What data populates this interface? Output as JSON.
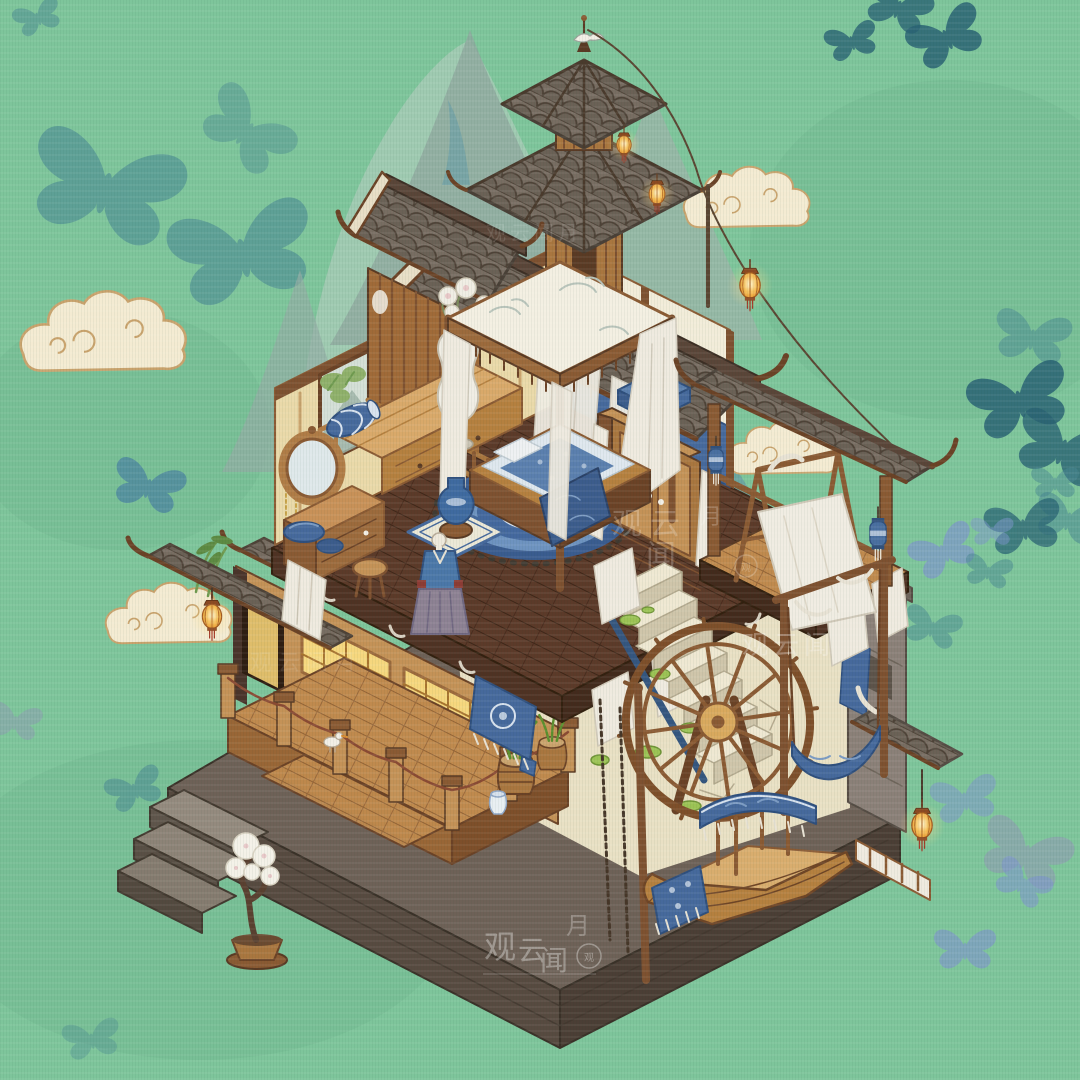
{
  "watermark": {
    "full": "观云闻月",
    "guan_yun": "观云",
    "guan": "观",
    "yun": "云",
    "wen": "闻",
    "yue": "月",
    "compact": "观云闻"
  },
  "palette": {
    "background": "#7ec59b",
    "butterfly_teal": "#4a8893",
    "butterfly_dark": "#2a6374",
    "butterfly_blue": "#7f97cc",
    "butterfly_steel": "#4b84a0",
    "butterfly_gray": "#8f9bb3",
    "butterfly_pale": "#cfd8d2",
    "mountain": "#8fa89f",
    "cloud": "#f4ebd2",
    "wood": "#b07c46",
    "wood_dark": "#8a5a33",
    "roof_tile": "#786d62",
    "stone_base": "#6e6157",
    "cream_wall": "#e9e0c4",
    "blue_fabric": "#46699c",
    "lantern_glow": "#f3b94e",
    "moss": "#9cc355"
  },
  "scene": {
    "butterflies": [
      {
        "x": 38,
        "y": 18,
        "s": 0.5,
        "r": -20,
        "c": "teal",
        "o": 0.5
      },
      {
        "x": 105,
        "y": 190,
        "s": 1.6,
        "r": 15,
        "c": "teal",
        "o": 0.6
      },
      {
        "x": 246,
        "y": 132,
        "s": 1.0,
        "r": 40,
        "c": "teal",
        "o": 0.42
      },
      {
        "x": 243,
        "y": 255,
        "s": 1.5,
        "r": -12,
        "c": "teal",
        "o": 0.6
      },
      {
        "x": 852,
        "y": 42,
        "s": 0.55,
        "r": -15,
        "c": "dark",
        "o": 0.8
      },
      {
        "x": 898,
        "y": 8,
        "s": 0.7,
        "r": 20,
        "c": "dark",
        "o": 0.8
      },
      {
        "x": 947,
        "y": 38,
        "s": 0.8,
        "r": -25,
        "c": "dark",
        "o": 0.85
      },
      {
        "x": 1032,
        "y": 338,
        "s": 0.8,
        "r": 10,
        "c": "teal",
        "o": 0.5
      },
      {
        "x": 1020,
        "y": 402,
        "s": 1.05,
        "r": -15,
        "c": "dark",
        "o": 0.85
      },
      {
        "x": 1062,
        "y": 450,
        "s": 1.0,
        "r": 20,
        "c": "dark",
        "o": 0.8
      },
      {
        "x": 1055,
        "y": 483,
        "s": 0.5,
        "r": 0,
        "c": "teal",
        "o": 0.5
      },
      {
        "x": 1068,
        "y": 520,
        "s": 0.7,
        "r": 15,
        "c": "teal",
        "o": 0.55
      },
      {
        "x": 1024,
        "y": 528,
        "s": 0.8,
        "r": -10,
        "c": "dark",
        "o": 0.75
      },
      {
        "x": 992,
        "y": 532,
        "s": 0.45,
        "r": 0,
        "c": "blue",
        "o": 0.5
      },
      {
        "x": 944,
        "y": 552,
        "s": 0.7,
        "r": -25,
        "c": "blue",
        "o": 0.7
      },
      {
        "x": 988,
        "y": 572,
        "s": 0.5,
        "r": 10,
        "c": "teal",
        "o": 0.5
      },
      {
        "x": 932,
        "y": 628,
        "s": 0.6,
        "r": 15,
        "c": "teal",
        "o": 0.5
      },
      {
        "x": 148,
        "y": 487,
        "s": 0.75,
        "r": 15,
        "c": "steel",
        "o": 0.75
      },
      {
        "x": 15,
        "y": 722,
        "s": 0.55,
        "r": 10,
        "c": "gray",
        "o": 0.5
      },
      {
        "x": 135,
        "y": 790,
        "s": 0.6,
        "r": -20,
        "c": "teal",
        "o": 0.55
      },
      {
        "x": 965,
        "y": 800,
        "s": 0.7,
        "r": -10,
        "c": "blue",
        "o": 0.55
      },
      {
        "x": 1025,
        "y": 855,
        "s": 0.95,
        "r": 20,
        "c": "gray",
        "o": 0.6
      },
      {
        "x": 1022,
        "y": 884,
        "s": 0.6,
        "r": 30,
        "c": "blue",
        "o": 0.6
      },
      {
        "x": 965,
        "y": 950,
        "s": 0.65,
        "r": 0,
        "c": "blue",
        "o": 0.65
      },
      {
        "x": 92,
        "y": 1040,
        "s": 0.6,
        "r": -10,
        "c": "teal",
        "o": 0.35
      },
      {
        "x": 500,
        "y": 182,
        "s": 0.3,
        "r": -10,
        "c": "pale",
        "o": 0.9
      }
    ]
  },
  "icons": {
    "butterfly": "butterfly-silhouette",
    "lantern": "hanging-lantern",
    "blue_lantern": "blue-cloth-lantern",
    "cloud": "auspicious-cloud",
    "bird": "white-bird",
    "seal": "artist-seal"
  }
}
